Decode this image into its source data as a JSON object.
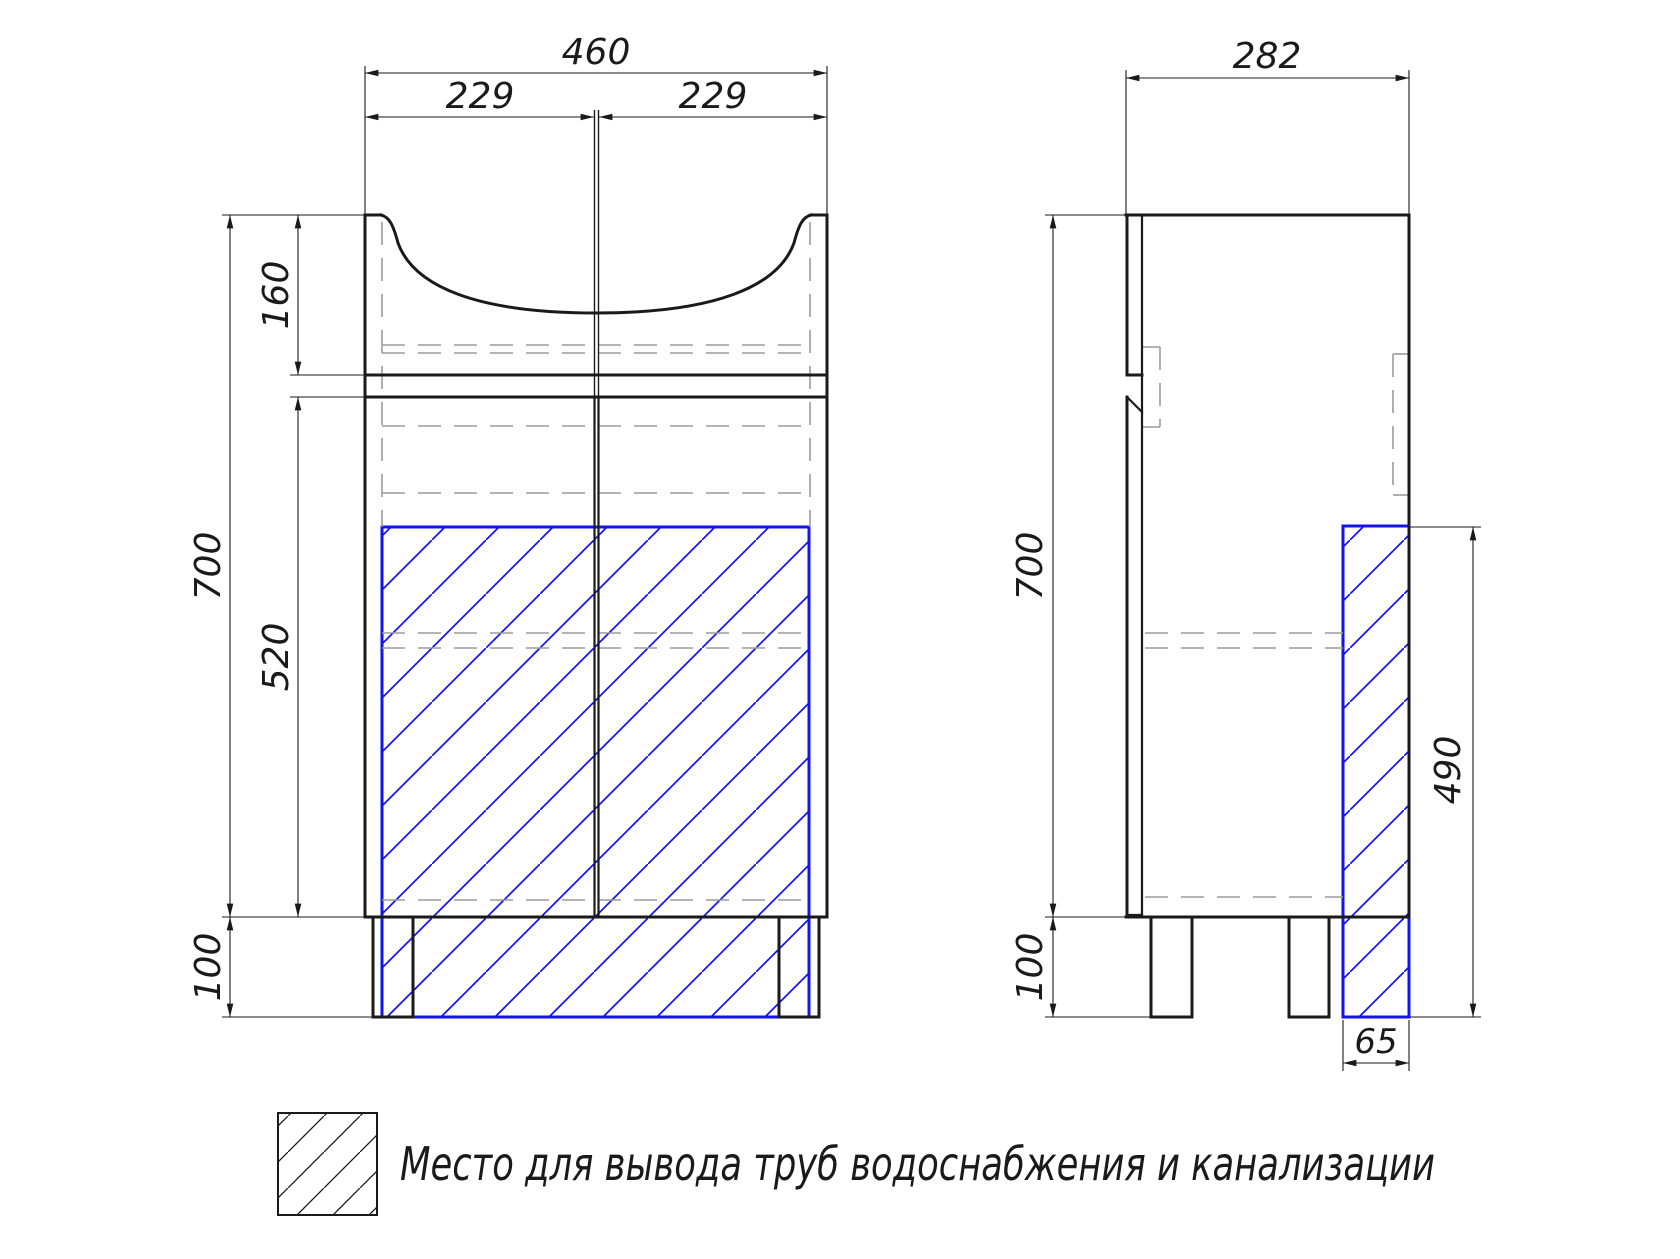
{
  "front_view": {
    "total_width": "460",
    "left_half": "229",
    "right_half": "229",
    "sink_height": "160",
    "total_height": "700",
    "body_height": "520",
    "leg_height": "100"
  },
  "side_view": {
    "depth": "282",
    "total_height": "700",
    "leg_height": "100",
    "pipe_zone_height": "490",
    "pipe_zone_width": "65"
  },
  "legend": {
    "label": "Место для вывода труб водоснабжения и канализации"
  },
  "colors": {
    "line": "#1a1a1a",
    "hidden_line": "#9b9b9b",
    "pipe_zone": "#1313ee",
    "background": "#ffffff"
  }
}
